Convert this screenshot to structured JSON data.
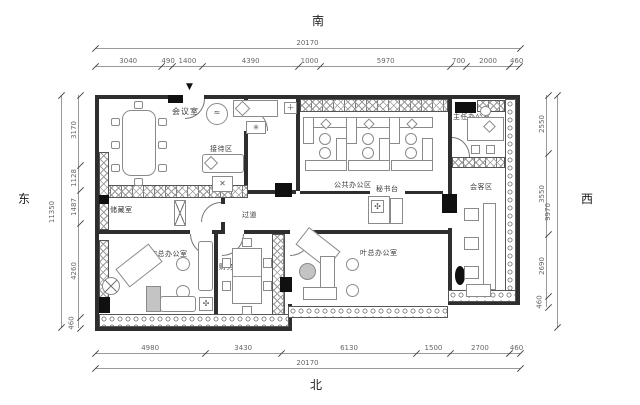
{
  "compass": {
    "south": "南",
    "north": "北",
    "east": "东",
    "west": "西"
  },
  "dims": {
    "top": {
      "total": "20170",
      "segments": [
        "3040",
        "490",
        "1400",
        "4390",
        "1000",
        "5970",
        "700",
        "2000",
        "460"
      ]
    },
    "bottom": {
      "total": "20170",
      "segments": [
        "4980",
        "3430",
        "6130",
        "1500",
        "2700",
        "460"
      ]
    },
    "left": {
      "total": "11350",
      "segments": [
        "3170",
        "1128",
        "1487",
        "4260",
        "460"
      ]
    },
    "right": {
      "total": "9970",
      "segments": [
        "2550",
        "3550",
        "2690",
        "460"
      ]
    }
  },
  "rooms": {
    "meeting": "会议室",
    "reception": "接待区",
    "open_office": "公共办公区",
    "director": "主任办公室",
    "guest": "会客区",
    "secretary": "秘书台",
    "storage": "储藏室",
    "corridor": "过道",
    "song_office": "宋总办公室",
    "finance": "财务室",
    "ye_office": "叶总办公室"
  },
  "icons": {
    "entrance_arrow": "▼",
    "fan": "✳",
    "cross": "✕",
    "plus": "＋",
    "flower": "✣",
    "squiggle": "≈"
  }
}
